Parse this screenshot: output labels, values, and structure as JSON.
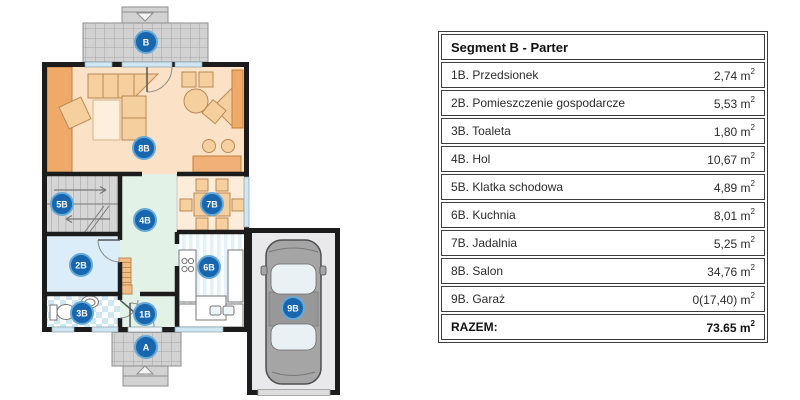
{
  "plan": {
    "labels": {
      "terrace_top": "B",
      "terrace_bottom": "A",
      "vestibule": "1B",
      "utility": "2B",
      "toilet": "3B",
      "hall": "4B",
      "stairs": "5B",
      "kitchen": "6B",
      "dining": "7B",
      "salon": "8B",
      "garage": "9B"
    }
  },
  "table": {
    "header": "Segment B - Parter",
    "unit_base": "m",
    "unit_exp": "2",
    "rows": [
      {
        "label": "1B. Przedsionek",
        "area": "2,74"
      },
      {
        "label": "2B. Pomieszczenie gospodarcze",
        "area": "5,53"
      },
      {
        "label": "3B. Toaleta",
        "area": "1,80"
      },
      {
        "label": "4B. Hol",
        "area": "10,67"
      },
      {
        "label": "5B. Klatka schodowa",
        "area": "4,89"
      },
      {
        "label": "6B. Kuchnia",
        "area": "8,01"
      },
      {
        "label": "7B. Jadalnia",
        "area": "5,25"
      },
      {
        "label": "8B. Salon",
        "area": "34,76"
      },
      {
        "label": "9B. Garaż",
        "area": "0(17,40)"
      }
    ],
    "total_label": "RAZEM:",
    "total_area": "73.65"
  },
  "colors": {
    "marker_blue": "#1766ae",
    "marker_ring": "#66a9d8",
    "wall": "#1c1c1c",
    "window": "#cfe7f2",
    "salon_floor": "#fbe2c6",
    "dining_floor": "#fdecd9",
    "hall_floor": "#e2f2e7",
    "utility_floor": "#dbedf8",
    "stairs_floor": "#d6d6d6",
    "garage_floor": "#e9e9eb",
    "terrace": "#d2d2d2",
    "furniture": "#f6cf9e",
    "furniture_dark": "#efa968"
  }
}
